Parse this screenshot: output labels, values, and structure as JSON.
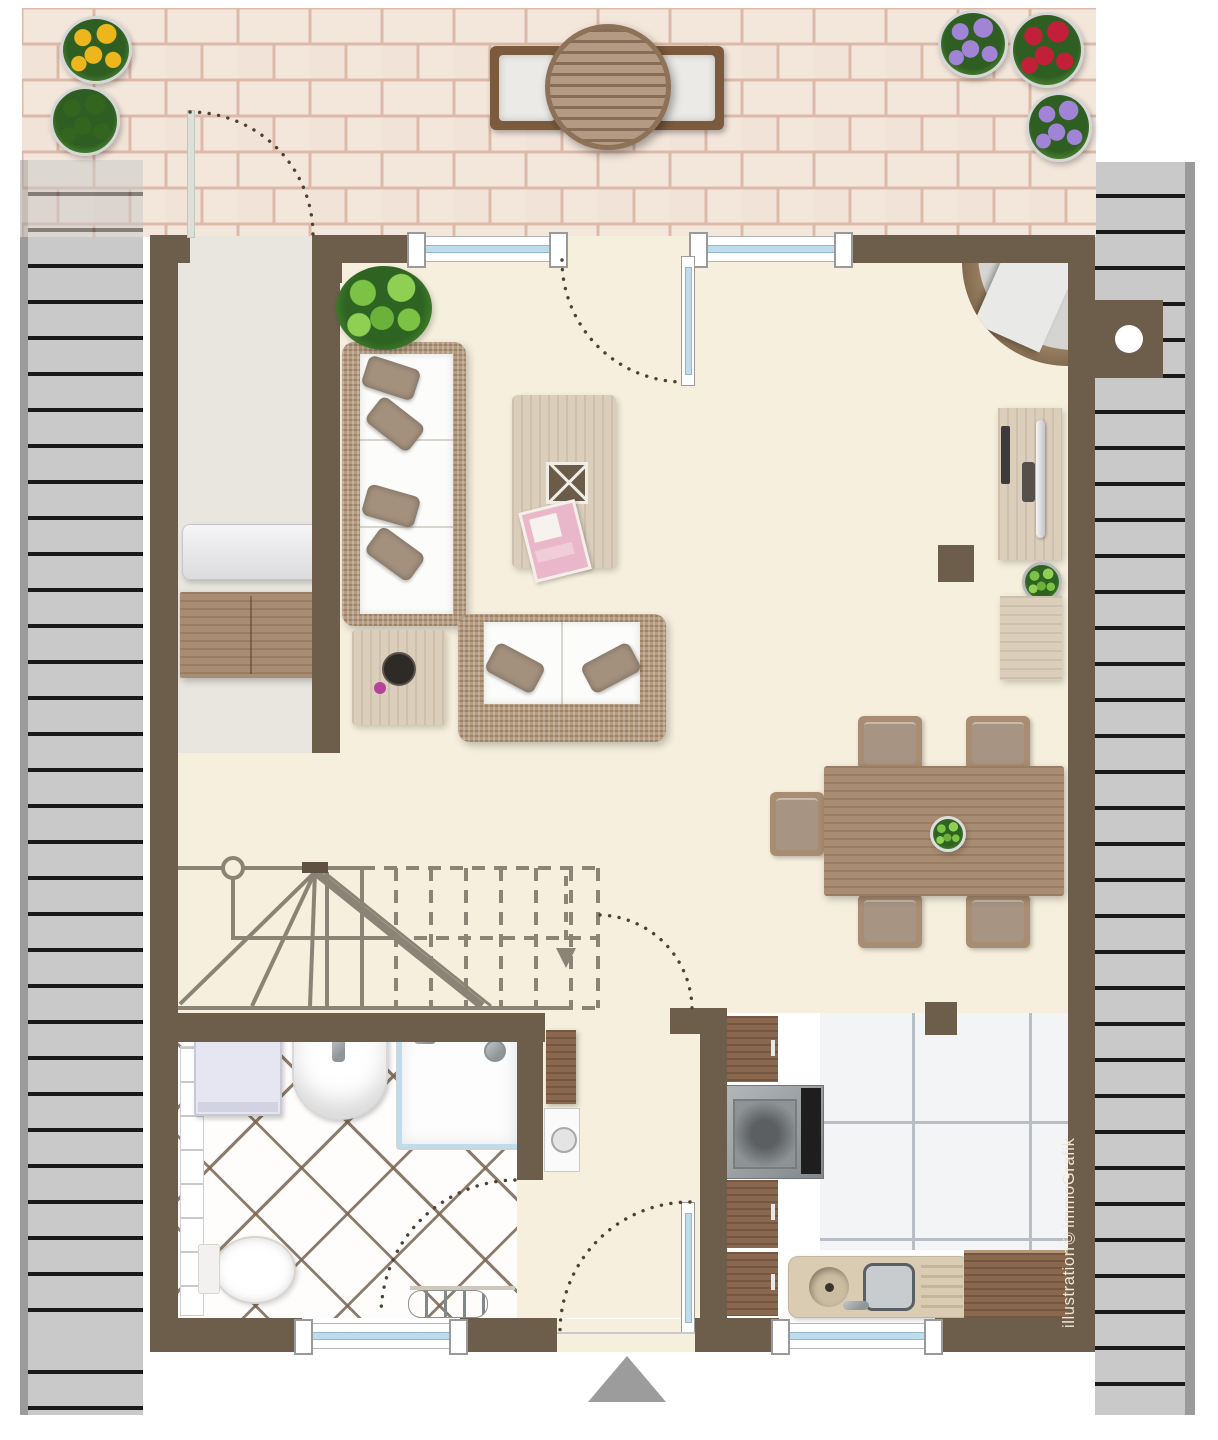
{
  "credit": {
    "text": "illustration©immoGrafik"
  },
  "palette": {
    "wall": "#6c5e4b",
    "floor": "#f6efdd",
    "entry": "#e9e6e0",
    "roof": "#c9c9c9",
    "roofEdge": "#9b9b9b",
    "roofLine": "#191919",
    "brick": "#f3e6db",
    "brickJoint": "#dcb9a8",
    "glass": "#bfdcec",
    "stair": "#8b8376",
    "arc": "#4d4234",
    "wicker": "#b59b7f",
    "cushion": "#fcfcfa",
    "pillow": "#a3907d",
    "woodL": "#dbcebb",
    "woodM": "#a98d72",
    "woodD": "#8a6850",
    "kgrout": "#b9bec4",
    "beige": "#d9ccb2",
    "credit": "#efe7d3",
    "arrow": "#9c9c9c"
  },
  "objects": [
    "patio",
    "patio-table",
    "patio-chair-left",
    "patio-chair-right",
    "flower-pot-sunflower",
    "flower-pot-shrub",
    "flower-pot-purple-1",
    "flower-pot-red",
    "flower-pot-purple-2",
    "roof-overhang-left",
    "roof-overhang-right",
    "terrace-window-left",
    "terrace-door",
    "terrace-window-right",
    "entry-room",
    "storage-chest",
    "sideboard",
    "potted-plant",
    "sofa",
    "loveseat",
    "coffee-table",
    "magazine-stack",
    "storage-basket",
    "side-table",
    "decor-bowl",
    "corner-fireplace",
    "chimney-flue",
    "wall-post",
    "desk",
    "monitor",
    "keyboard",
    "desk-plant",
    "desk-cabinet",
    "dining-table",
    "dining-chairs",
    "centerpiece-plant",
    "staircase",
    "stair-direction-arrow",
    "bathroom",
    "washing-machine",
    "bathroom-sink",
    "shower",
    "toilet",
    "towel-radiator",
    "wall-radiator",
    "tall-cupboard",
    "hall-appliance",
    "hallway",
    "front-door",
    "entrance-arrow",
    "kitchen",
    "kitchen-cabinets",
    "stove",
    "kitchen-sink",
    "kitchen-counter-wood",
    "kitchen-pillar",
    "kitchen-window",
    "bathroom-window"
  ]
}
